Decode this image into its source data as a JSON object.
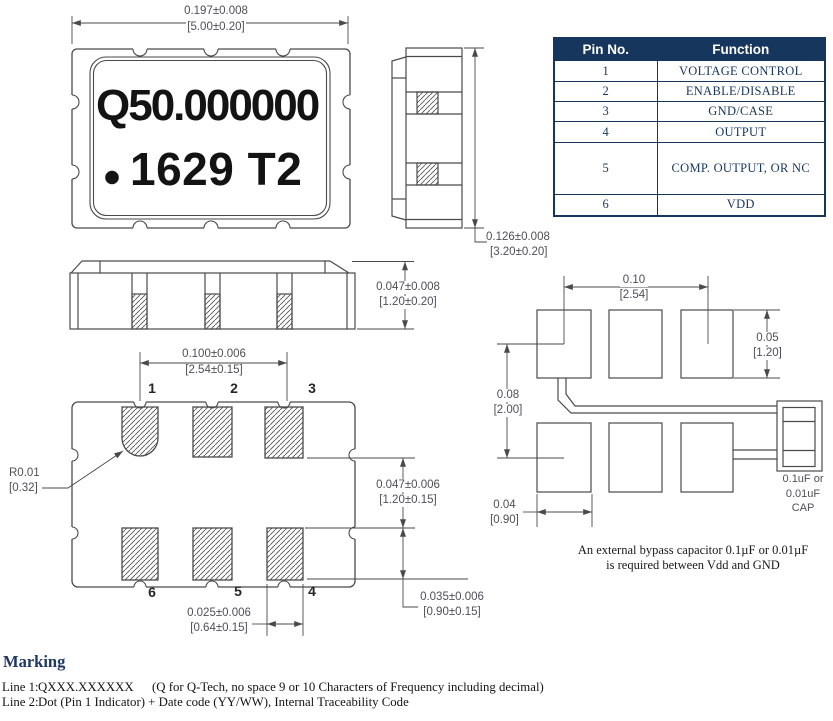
{
  "pin_table": {
    "headers": [
      "Pin No.",
      "Function"
    ],
    "rows": [
      {
        "pin": "1",
        "function": "VOLTAGE CONTROL"
      },
      {
        "pin": "2",
        "function": "ENABLE/DISABLE"
      },
      {
        "pin": "3",
        "function": "GND/CASE"
      },
      {
        "pin": "4",
        "function": "OUTPUT"
      },
      {
        "pin": "5",
        "function": "COMP. OUTPUT, OR NC"
      },
      {
        "pin": "6",
        "function": "VDD"
      }
    ]
  },
  "package_marking": {
    "frequency": "Q50.000000",
    "date_code": "1629 T2"
  },
  "dimensions": {
    "body_width": {
      "inch": "0.197±0.008",
      "mm": "[5.00±0.20]"
    },
    "body_height": {
      "inch": "0.126±0.008",
      "mm": "[3.20±0.20]"
    },
    "seated_height": {
      "inch": "0.047±0.008",
      "mm": "[1.20±0.20]"
    },
    "pad_pitch": {
      "inch": "0.100±0.006",
      "mm": "[2.54±0.15]"
    },
    "pad_row_gap": {
      "inch": "0.047±0.006",
      "mm": "[1.20±0.15]"
    },
    "pad_length": {
      "inch": "0.035±0.006",
      "mm": "[0.90±0.15]"
    },
    "pad_width": {
      "inch": "0.025±0.006",
      "mm": "[0.64±0.15]"
    },
    "pin1_radius": {
      "inch": "R0.01",
      "mm": "[0.32]"
    }
  },
  "bottom_view": {
    "pin_labels": [
      "1",
      "2",
      "3",
      "6",
      "5",
      "4"
    ]
  },
  "land_pattern": {
    "pitch": {
      "inch": "0.10",
      "mm": "[2.54]"
    },
    "pad_height": {
      "inch": "0.05",
      "mm": "[1.20]"
    },
    "row_spacing": {
      "inch": "0.08",
      "mm": "[2.00]"
    },
    "pad_width": {
      "inch": "0.04",
      "mm": "[0.90]"
    },
    "cap_label_line1": "0.1uF or",
    "cap_label_line2": "0.01uF",
    "cap_label_line3": "CAP",
    "note_line1": "An external bypass capacitor 0.1µF or 0.01µF",
    "note_line2": "is required between Vdd and GND"
  },
  "marking_section": {
    "title": "Marking",
    "line1_label": "Line 1:",
    "line1_value": "QXXX.XXXXXX",
    "line1_note": "(Q for Q-Tech, no space 9 or 10 Characters of Frequency including decimal)",
    "line2_label": "Line 2:",
    "line2_value": "Dot (Pin 1 Indicator) + Date code (YY/WW), Internal Traceability Code"
  },
  "colors": {
    "table_header_bg": "#17365d",
    "table_text": "#17365d",
    "heading": "#1f3864",
    "line": "#4a4a4a",
    "dim_text": "#4f4f55"
  }
}
